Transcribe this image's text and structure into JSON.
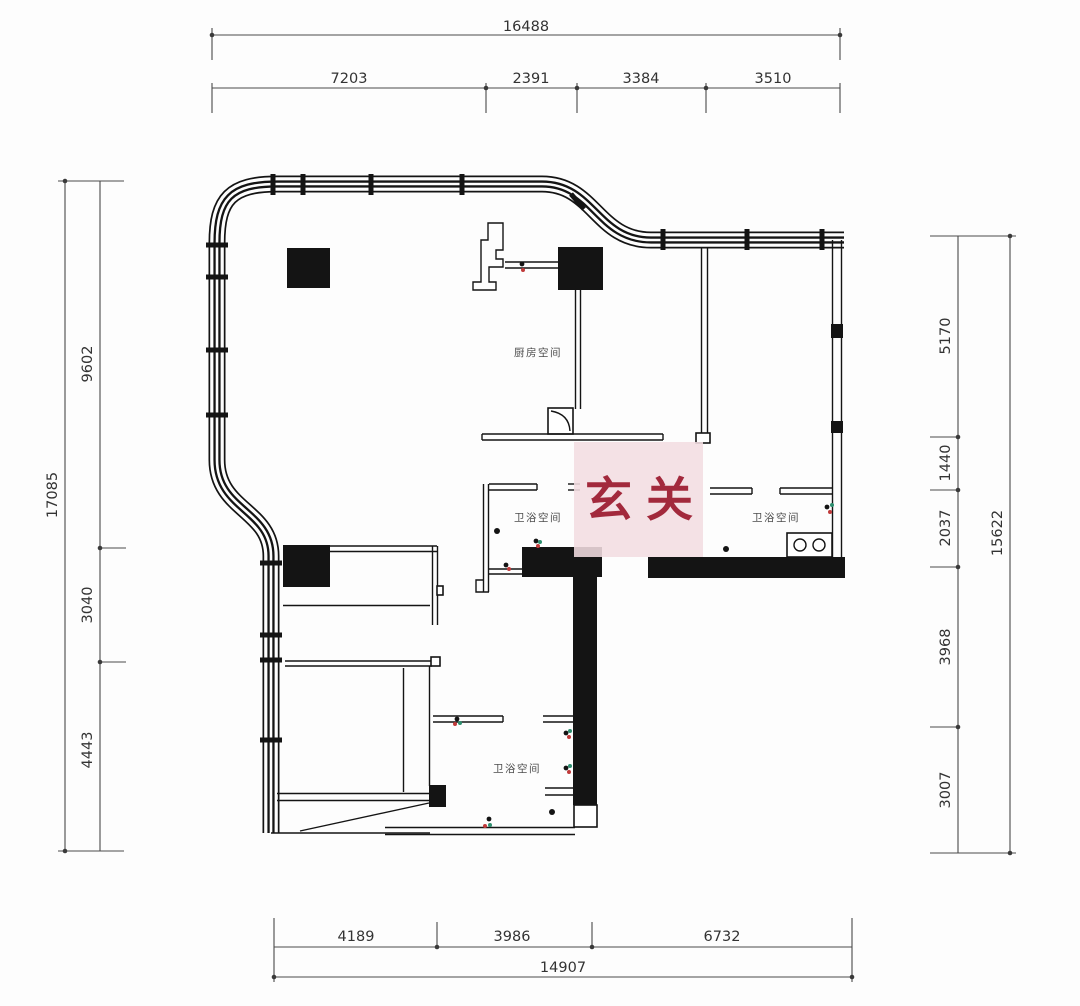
{
  "drawing": {
    "kind": "residential floor plan"
  },
  "highlight": {
    "label": "玄关"
  },
  "rooms": {
    "kitchen": "厨房空间",
    "bath_mid": "卫浴空间",
    "bath_right": "卫浴空间",
    "bath_bottom": "卫浴空间"
  },
  "dimensions": {
    "top": {
      "total": "16488",
      "segments": [
        "7203",
        "2391",
        "3384",
        "3510"
      ]
    },
    "left": {
      "total": "17085",
      "segments": [
        "9602",
        "3040",
        "4443"
      ]
    },
    "right": {
      "total": "15622",
      "segments": [
        "5170",
        "1440",
        "2037",
        "3968",
        "3007"
      ]
    },
    "bottom": {
      "total": "14907",
      "segments": [
        "4189",
        "3986",
        "6732"
      ]
    }
  },
  "colors": {
    "wall": "#141414",
    "dimension": "#3c3c3c",
    "highlight_bg": "#f2dde1",
    "highlight_text": "#a2293c",
    "marker_red": "#c03a3a",
    "marker_green": "#2e8f6f"
  }
}
